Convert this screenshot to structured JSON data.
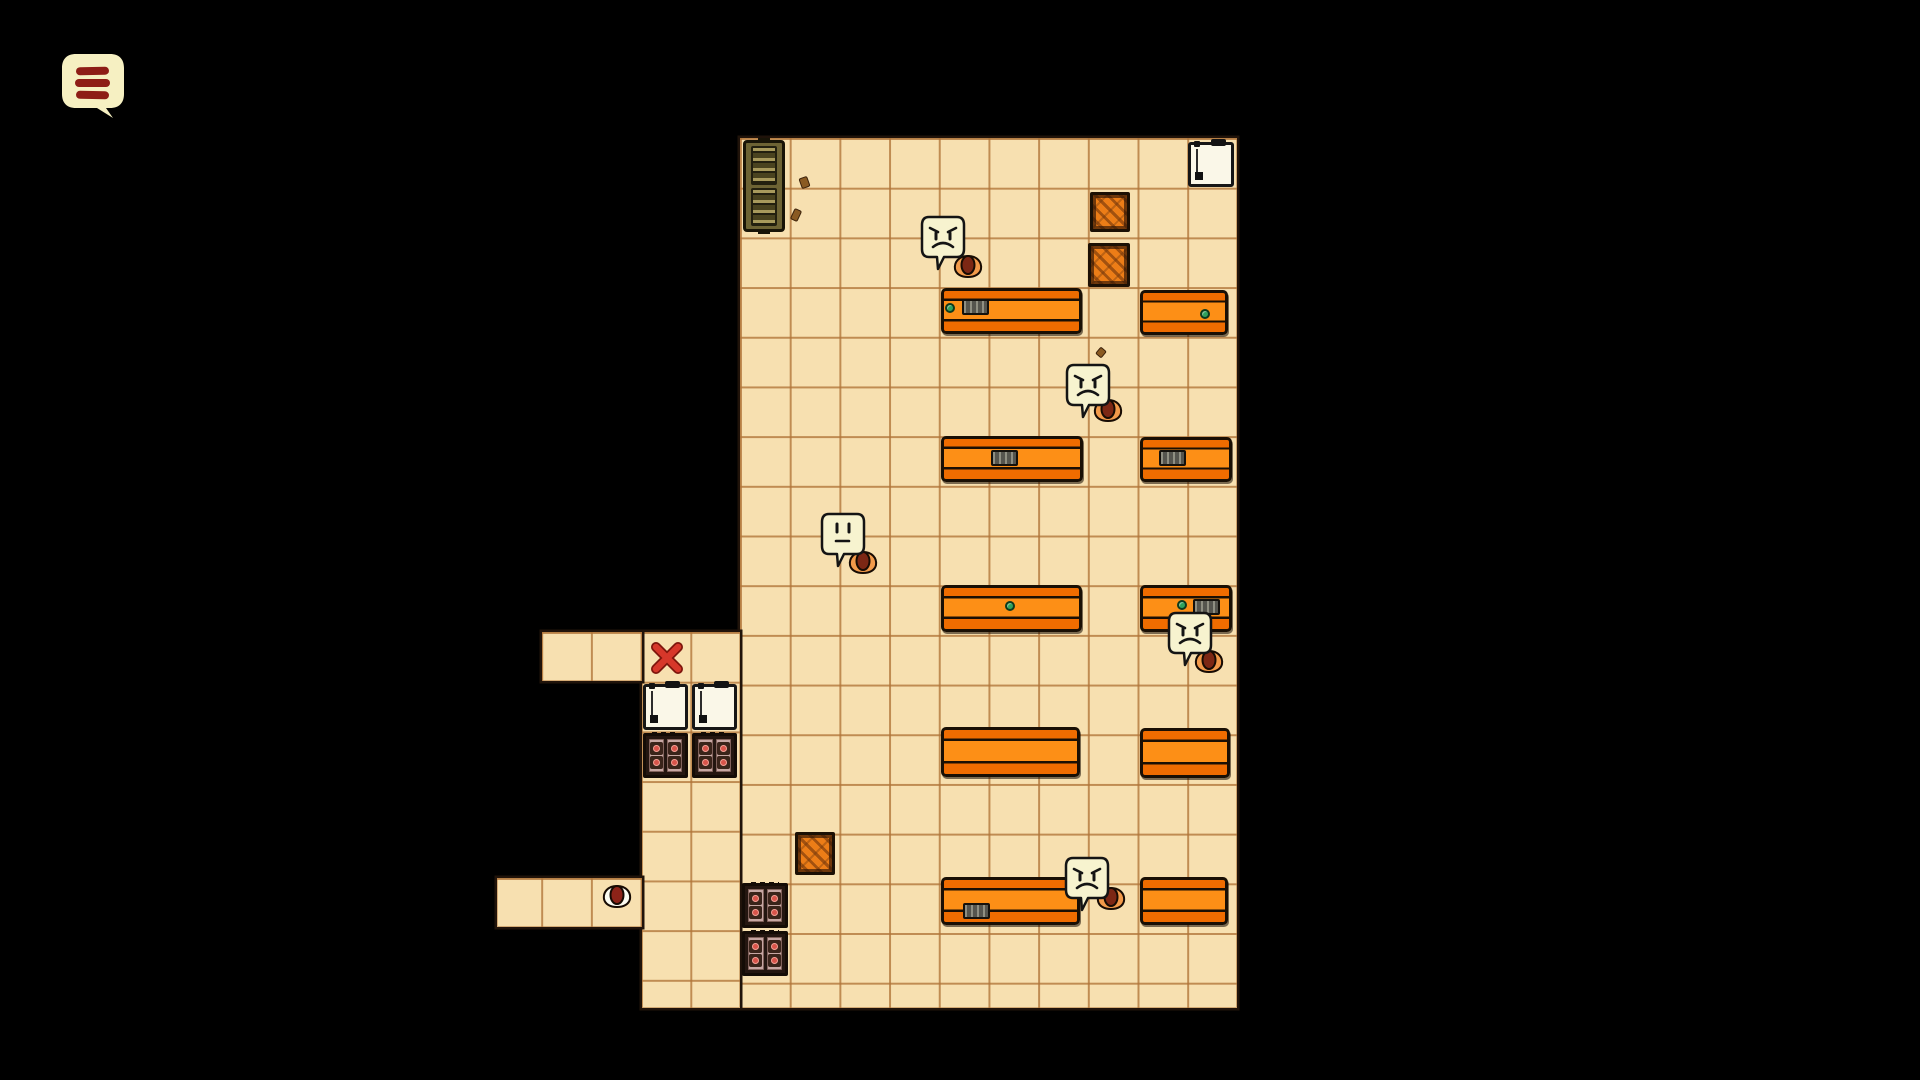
{
  "app": {
    "kind": "top-down room game scene",
    "background": "#000000"
  },
  "hud": {
    "menu_button": {
      "icon": "hamburger-menu-icon",
      "bubble_color": "#f6f0c2",
      "bar_color": "#8e1d16",
      "bar_count": 3
    }
  },
  "palette": {
    "floor": "#f7e0b0",
    "grid_line": "#b07438",
    "desk_orange": "#fd8f16",
    "desk_outline": "#190f04",
    "crate_orange": "#ec7d17",
    "locker_olive": "#6d6334",
    "appliance_white": "#faf7e8",
    "stove_pink": "#c7a7a3",
    "burner_red": "#d9544a",
    "bubble_cream": "#f7f3cf",
    "critter_orange": "#f29a4a",
    "critter_core": "#7c2714",
    "mouse_white": "#fcfcf2",
    "x_red": "#d7372a",
    "item_green": "#2fa25c"
  },
  "scene": {
    "tile": {
      "size": 49.7,
      "origin_x": 740,
      "origin_y": 138
    },
    "regions": [
      {
        "name": "main-room",
        "x": 740,
        "y": 138,
        "w": 497,
        "h": 870
      },
      {
        "name": "annex-left-column",
        "x": 642,
        "y": 632,
        "w": 98,
        "h": 376
      },
      {
        "name": "annex-top-strip",
        "x": 542,
        "y": 632,
        "w": 100,
        "h": 49
      },
      {
        "name": "annex-bottom-strip",
        "x": 497,
        "y": 878,
        "w": 145,
        "h": 49
      }
    ],
    "objects": [
      {
        "type": "locker",
        "name": "supply-locker",
        "x": 743,
        "y": 140,
        "w": 42,
        "h": 92
      },
      {
        "type": "fridge",
        "name": "white-appliance",
        "x": 1188,
        "y": 142,
        "w": 46,
        "h": 45
      },
      {
        "type": "crate",
        "name": "wooden-crate",
        "x": 1090,
        "y": 192,
        "w": 40,
        "h": 40
      },
      {
        "type": "crate",
        "name": "wooden-crate",
        "x": 1088,
        "y": 243,
        "w": 42,
        "h": 44
      },
      {
        "type": "crate",
        "name": "wooden-crate",
        "x": 795,
        "y": 832,
        "w": 40,
        "h": 43
      },
      {
        "type": "desk",
        "name": "office-desk",
        "x": 941,
        "y": 288,
        "w": 141,
        "h": 46
      },
      {
        "type": "desk",
        "name": "office-desk",
        "x": 1140,
        "y": 290,
        "w": 88,
        "h": 45
      },
      {
        "type": "desk",
        "name": "office-desk",
        "x": 941,
        "y": 436,
        "w": 142,
        "h": 46
      },
      {
        "type": "desk",
        "name": "office-desk",
        "x": 1140,
        "y": 437,
        "w": 92,
        "h": 45
      },
      {
        "type": "desk",
        "name": "office-desk",
        "x": 941,
        "y": 585,
        "w": 141,
        "h": 47
      },
      {
        "type": "desk",
        "name": "office-desk",
        "x": 1140,
        "y": 585,
        "w": 92,
        "h": 47
      },
      {
        "type": "desk",
        "name": "office-desk",
        "x": 941,
        "y": 727,
        "w": 139,
        "h": 50
      },
      {
        "type": "desk",
        "name": "office-desk",
        "x": 1140,
        "y": 728,
        "w": 90,
        "h": 50
      },
      {
        "type": "desk",
        "name": "office-desk",
        "x": 941,
        "y": 877,
        "w": 139,
        "h": 48
      },
      {
        "type": "desk",
        "name": "office-desk",
        "x": 1140,
        "y": 877,
        "w": 88,
        "h": 48
      },
      {
        "type": "fridge",
        "name": "refrigerator",
        "x": 643,
        "y": 684,
        "w": 45,
        "h": 46
      },
      {
        "type": "fridge",
        "name": "refrigerator",
        "x": 692,
        "y": 684,
        "w": 45,
        "h": 46
      },
      {
        "type": "stove",
        "name": "stove",
        "x": 643,
        "y": 733,
        "w": 45,
        "h": 45
      },
      {
        "type": "stove",
        "name": "stove",
        "x": 692,
        "y": 733,
        "w": 45,
        "h": 45
      },
      {
        "type": "stove",
        "name": "stove",
        "x": 742,
        "y": 883,
        "w": 46,
        "h": 45
      },
      {
        "type": "stove",
        "name": "stove",
        "x": 742,
        "y": 931,
        "w": 46,
        "h": 45
      },
      {
        "type": "green",
        "name": "green-item",
        "x": 945,
        "y": 303
      },
      {
        "type": "keyboard",
        "name": "keyboard-item",
        "x": 962,
        "y": 299
      },
      {
        "type": "green",
        "name": "green-item",
        "x": 1200,
        "y": 309
      },
      {
        "type": "keyboard",
        "name": "keyboard-item",
        "x": 991,
        "y": 450
      },
      {
        "type": "keyboard",
        "name": "keyboard-item",
        "x": 1159,
        "y": 450
      },
      {
        "type": "green",
        "name": "green-item",
        "x": 1005,
        "y": 601
      },
      {
        "type": "green",
        "name": "green-item",
        "x": 1177,
        "y": 600
      },
      {
        "type": "keyboard",
        "name": "keyboard-item",
        "x": 1193,
        "y": 599
      },
      {
        "type": "keyboard",
        "name": "keyboard-item",
        "x": 963,
        "y": 903
      },
      {
        "type": "xmark",
        "name": "red-x-mark",
        "x": 650,
        "y": 641,
        "w": 34,
        "h": 34
      },
      {
        "type": "debris",
        "name": "debris",
        "x": 800,
        "y": 177,
        "w": 9,
        "h": 11,
        "rot": -20
      },
      {
        "type": "debris",
        "name": "debris",
        "x": 792,
        "y": 209,
        "w": 8,
        "h": 12,
        "rot": 25
      },
      {
        "type": "debris",
        "name": "debris",
        "x": 1097,
        "y": 348,
        "w": 8,
        "h": 9,
        "rot": 40
      },
      {
        "type": "npc",
        "name": "angry-critter",
        "mood": "angry",
        "bubble": {
          "x": 919,
          "y": 214
        },
        "critter": {
          "x": 951,
          "y": 253
        }
      },
      {
        "type": "npc",
        "name": "angry-critter",
        "mood": "angry",
        "bubble": {
          "x": 1064,
          "y": 362
        },
        "critter": {
          "x": 1091,
          "y": 397
        }
      },
      {
        "type": "npc",
        "name": "worried-critter",
        "mood": "neutral",
        "bubble": {
          "x": 819,
          "y": 511
        },
        "critter": {
          "x": 846,
          "y": 549
        }
      },
      {
        "type": "npc",
        "name": "angry-critter",
        "mood": "angry",
        "bubble": {
          "x": 1166,
          "y": 610
        },
        "critter": {
          "x": 1192,
          "y": 648
        }
      },
      {
        "type": "npc",
        "name": "angry-critter",
        "mood": "angry",
        "bubble": {
          "x": 1063,
          "y": 855
        },
        "critter": {
          "x": 1094,
          "y": 885
        }
      },
      {
        "type": "mouse",
        "name": "white-mouse",
        "x": 600,
        "y": 883,
        "w": 33,
        "h": 27
      }
    ]
  }
}
